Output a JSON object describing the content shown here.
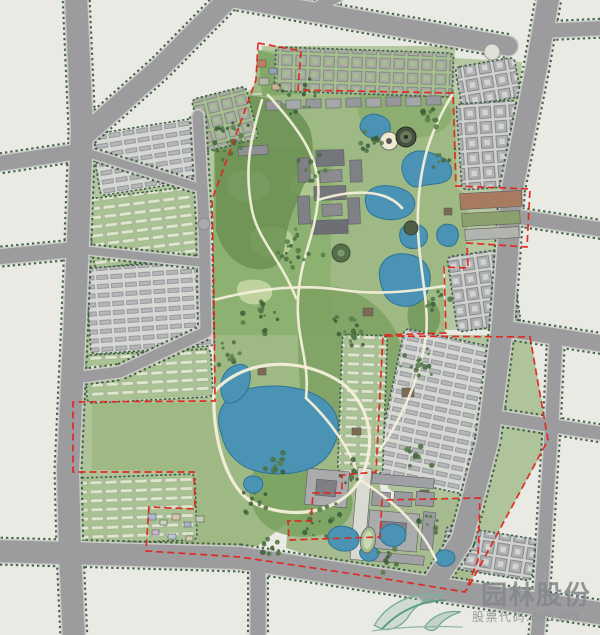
{
  "watermark": {
    "reg": "®",
    "company": "园林股份",
    "stock": "股票代码:605303",
    "logo_icon": "leaf-swirl-icon",
    "text_color": "#85888b",
    "logo_color": "#6fa18e"
  },
  "palette": {
    "background": "#e8eae3",
    "road": "#9c9c9e",
    "road_edge": "#cbccc6",
    "tree_line": "#3a5a42",
    "park_green": "#9fb985",
    "forest_green": "#6b9152",
    "lake_blue": "#4a93b4",
    "boundary_red": "#e3251c",
    "path_cream": "#f4efda",
    "building_gray": "#9a9b9f"
  },
  "map": {
    "w": 600,
    "h": 635,
    "bg": "#e8eae3",
    "belts": [
      {
        "d": "M88,136 L200,120 L253,88 L253,148 L212,200 L210,335 L120,372 L80,375 L74,340 L78,240 Z",
        "fill": "#b4c79f"
      },
      {
        "d": "M74,378 L120,374 L208,334 L213,402 L92,403 L92,470 L196,472 L196,545 L72,550 Z",
        "fill": "#aec39a"
      },
      {
        "d": "M262,46 L455,46 L455,96 L262,98 Z",
        "fill": "#b6c8a2"
      },
      {
        "d": "M455,58 L522,62 L512,190 L502,330 L445,330 L445,267 L466,268 L467,243 L456,244 L456,186 Z",
        "fill": "#b6c8a2"
      },
      {
        "d": "M385,334 L530,336 L549,440 L466,590 L428,586 L443,530 L388,488 Z",
        "fill": "#b0c49c"
      },
      {
        "d": "M288,523 L311,521 L313,493 L341,493 L341,475 L378,472 L382,500 L480,498 L477,562 L464,592 L380,578 L286,548 Z",
        "fill": "#a6bc90"
      }
    ],
    "parkShapes": [
      {
        "d": "M213,95 L455,92 L457,188 L468,196 L466,268 L443,267 L445,334 L383,336 L375,472 L341,475 L341,493 L313,493 L311,521 L288,522 L258,546 L150,552 L152,508 L196,508 L196,472 L92,470 L92,403 L214,402 L213,200 L255,82 L258,50 L298,52 L295,92 Z",
        "fill": "#9fb985"
      }
    ],
    "patches": [
      {
        "d": "M214,150 L332,148 L330,335 L212,335 Z",
        "fill": "#8cb170",
        "op": 1
      },
      {
        "d": "M230,175 C250,165 272,172 270,188 C268,202 240,206 232,196 C226,188 224,182 230,175 Z",
        "fill": "#c3d7a3",
        "op": 0.9
      },
      {
        "d": "M255,230 C275,222 296,228 293,244 C290,258 262,262 254,250 C248,241 248,236 255,230 Z",
        "fill": "#bcd19c",
        "op": 0.9
      },
      {
        "d": "M240,282 C258,276 274,282 272,294 C270,306 246,308 240,298 C236,291 236,287 240,282 Z",
        "fill": "#c3d7a3",
        "op": 0.9
      },
      {
        "d": "M296,175 C310,170 320,176 318,188 C316,200 298,202 292,192 C288,185 290,180 296,175 Z",
        "fill": "#b7cd97",
        "op": 0.8
      },
      {
        "d": "M214,96 C260,92 300,100 310,130 C320,160 300,190 290,220 C282,246 288,262 270,268 C248,274 224,260 216,230 Z",
        "fill": "#6b9152",
        "op": 0.85
      },
      {
        "d": "M300,290 C330,280 360,290 380,310 C400,330 410,360 400,390 C390,420 370,430 350,440 C330,450 310,440 305,420 C298,390 296,330 300,290 Z",
        "fill": "#7aa05f",
        "op": 0.8
      },
      {
        "d": "M255,470 C285,460 320,465 340,480 C360,495 355,520 335,530 C310,542 275,538 260,520 C248,505 246,482 255,470 Z",
        "fill": "#77a05c",
        "op": 0.8
      },
      {
        "d": "M360,95 C400,92 440,95 452,110 C455,130 430,140 400,138 C370,136 350,120 360,95 Z",
        "fill": "#84a968",
        "op": 0.7
      },
      {
        "d": "M258,50 C285,55 305,72 303,94 L262,96 Z",
        "fill": "#7fa765",
        "op": 0.9
      },
      {
        "d": "M300,55 C330,52 360,55 358,70 C356,84 320,88 305,80 C295,73 294,62 300,55 Z",
        "fill": "#bed3a0",
        "op": 0.8
      },
      {
        "d": "M380,420 C400,412 420,418 418,434 C416,448 392,452 384,442 C378,434 376,428 380,420 Z",
        "fill": "#b5cc96",
        "op": 0.9
      },
      {
        "d": "M412,300 C430,295 442,305 440,320 C438,338 420,342 412,332 C406,324 406,308 412,300 Z",
        "fill": "#6f9556",
        "op": 0.8
      },
      {
        "d": "M225,415 C245,405 268,408 270,424 C272,440 248,448 234,440 C224,434 220,424 225,415 Z",
        "fill": "#b8cf99",
        "op": 0.6
      }
    ],
    "blockStyles": {
      "slab": {
        "bg": "#d6d8d3",
        "pat": "patSlab"
      },
      "greenrow": {
        "bg": "#a9c294",
        "pat": "patGreenrow"
      },
      "court": {
        "bg": "#cfd1cd",
        "pat": "patCourt"
      },
      "greencourt": {
        "bg": "#a5bf90",
        "pat": "patGreencourt"
      }
    },
    "blocks": [
      [
        197,
        92,
        56,
        54,
        -14,
        "greencourt"
      ],
      [
        95,
        126,
        105,
        62,
        -9,
        "slab"
      ],
      [
        90,
        192,
        115,
        70,
        -7,
        "greenrow"
      ],
      [
        88,
        264,
        124,
        86,
        -4,
        "slab"
      ],
      [
        86,
        352,
        126,
        48,
        -3,
        "greenrow"
      ],
      [
        78,
        476,
        118,
        66,
        -2,
        "greenrow"
      ],
      [
        275,
        50,
        178,
        44,
        2,
        "greencourt"
      ],
      [
        458,
        62,
        60,
        40,
        -10,
        "court"
      ],
      [
        459,
        102,
        60,
        86,
        -4,
        "court"
      ],
      [
        452,
        252,
        64,
        76,
        -8,
        "court"
      ],
      [
        388,
        337,
        100,
        150,
        12,
        "slab"
      ],
      [
        340,
        335,
        45,
        138,
        2,
        "greenrow"
      ],
      [
        443,
        532,
        92,
        42,
        9,
        "court"
      ]
    ],
    "roads": [
      {
        "d": "M76,-5 L82,130 L78,240 L74,340 L68,470 L70,552 L74,640",
        "w": 22
      },
      {
        "d": "M230,-3 L160,68 L86,134",
        "w": 20
      },
      {
        "d": "M-4,164 L82,151",
        "w": 15
      },
      {
        "d": "M-4,257 L80,249",
        "w": 15
      },
      {
        "d": "M228,-3 L370,22 L508,46",
        "w": 19
      },
      {
        "d": "M305,14 L338,-4",
        "w": 11
      },
      {
        "d": "M549,-5 L536,70 L512,190 L502,330 L488,440 L462,540 L428,592",
        "w": 21
      },
      {
        "d": "M540,31 L605,28",
        "w": 14
      },
      {
        "d": "M505,215 L605,230",
        "w": 14
      },
      {
        "d": "M500,328 L605,344",
        "w": 16
      },
      {
        "d": "M503,418 L605,434",
        "w": 13
      },
      {
        "d": "M556,338 L552,420 L542,580 L537,640",
        "w": 13
      },
      {
        "d": "M-5,551 L240,558 L420,586 L605,614",
        "w": 22
      },
      {
        "d": "M258,561 L258,640",
        "w": 15
      },
      {
        "d": "M198,116 L204,222 L206,332 L120,372 L74,378",
        "w": 11
      },
      {
        "d": "M88,153 L200,188",
        "w": 8
      },
      {
        "d": "M82,250 L205,263",
        "w": 8
      }
    ],
    "roundabouts": [
      [
        204,
        224,
        6
      ]
    ],
    "buildings": [
      [
        316,
        150,
        28,
        16,
        -2,
        "#75767b"
      ],
      [
        320,
        170,
        22,
        12,
        -2,
        "#8b8c90"
      ],
      [
        314,
        186,
        32,
        14,
        -2,
        "#75767b"
      ],
      [
        322,
        204,
        20,
        12,
        -2,
        "#8b8c90"
      ],
      [
        312,
        220,
        36,
        14,
        -2,
        "#6e6f74"
      ],
      [
        298,
        158,
        12,
        24,
        -2,
        "#808186"
      ],
      [
        350,
        160,
        12,
        22,
        -2,
        "#808186"
      ],
      [
        298,
        196,
        12,
        28,
        -2,
        "#808186"
      ],
      [
        348,
        198,
        12,
        26,
        -2,
        "#808186"
      ],
      [
        238,
        146,
        30,
        9,
        -4,
        "#8f9094"
      ],
      [
        266,
        101,
        15,
        9,
        -1,
        "#97989c"
      ],
      [
        286,
        100,
        15,
        9,
        -1,
        "#a6a7aa"
      ],
      [
        306,
        99,
        15,
        9,
        -1,
        "#97989c"
      ],
      [
        326,
        99,
        15,
        9,
        -1,
        "#a6a7aa"
      ],
      [
        346,
        98,
        15,
        9,
        -1,
        "#97989c"
      ],
      [
        366,
        98,
        15,
        9,
        -1,
        "#a6a7aa"
      ],
      [
        386,
        97,
        15,
        9,
        -1,
        "#97989c"
      ],
      [
        406,
        97,
        15,
        9,
        -1,
        "#a6a7aa"
      ],
      [
        426,
        96,
        15,
        9,
        -1,
        "#97989c"
      ],
      [
        430,
        163,
        10,
        8,
        0,
        "#7c6a52"
      ],
      [
        444,
        208,
        8,
        7,
        0,
        "#7c6a52"
      ],
      [
        363,
        308,
        10,
        8,
        0,
        "#7c6a52"
      ],
      [
        258,
        368,
        8,
        7,
        0,
        "#7c6a52"
      ],
      [
        402,
        388,
        12,
        9,
        0,
        "#7c6a52"
      ],
      [
        352,
        428,
        9,
        7,
        0,
        "#7c6a52"
      ],
      [
        298,
        452,
        10,
        8,
        0,
        "#7c6a52"
      ],
      [
        420,
        490,
        9,
        7,
        0,
        "#7c6a52"
      ],
      [
        306,
        470,
        42,
        36,
        5,
        "#a9abad"
      ],
      [
        316,
        480,
        20,
        16,
        5,
        "#7e7f83"
      ],
      [
        354,
        468,
        14,
        92,
        5,
        "#d9dad2"
      ],
      [
        372,
        476,
        62,
        10,
        5,
        "#a0a1a5"
      ],
      [
        372,
        492,
        18,
        14,
        5,
        "#9a9b9f"
      ],
      [
        394,
        492,
        18,
        14,
        5,
        "#9a9b9f"
      ],
      [
        416,
        492,
        18,
        14,
        5,
        "#9a9b9f"
      ],
      [
        368,
        512,
        50,
        38,
        5,
        "#a9abad"
      ],
      [
        380,
        522,
        26,
        18,
        5,
        "#7e7f83"
      ],
      [
        422,
        512,
        12,
        38,
        5,
        "#9a9b9f"
      ],
      [
        372,
        554,
        52,
        9,
        5,
        "#a0a1a5"
      ],
      [
        460,
        192,
        62,
        16,
        -3,
        "#a87a5f"
      ],
      [
        462,
        212,
        58,
        13,
        -3,
        "#8ba06c"
      ],
      [
        465,
        228,
        54,
        11,
        -3,
        "#b2b4af"
      ],
      [
        257,
        60,
        9,
        7,
        0,
        "#c07c5c"
      ],
      [
        269,
        68,
        8,
        6,
        0,
        "#93a3bb"
      ],
      [
        259,
        78,
        10,
        7,
        0,
        "#b1b9a2"
      ],
      [
        272,
        84,
        8,
        6,
        0,
        "#c9b48e"
      ],
      [
        148,
        514,
        8,
        6,
        0,
        "#aab8cc"
      ],
      [
        160,
        520,
        7,
        5,
        0,
        "#cdd5ba"
      ],
      [
        172,
        514,
        8,
        6,
        0,
        "#d8c7a6"
      ],
      [
        184,
        522,
        7,
        5,
        0,
        "#a3b8c6"
      ],
      [
        196,
        516,
        8,
        6,
        0,
        "#c2cdb4"
      ],
      [
        152,
        530,
        7,
        5,
        0,
        "#c8b8d0"
      ],
      [
        168,
        534,
        8,
        5,
        0,
        "#b8c8d8"
      ],
      [
        186,
        536,
        7,
        5,
        0,
        "#d5cead"
      ]
    ],
    "lakeStyle": {
      "fill": "#4a93b4",
      "stroke": "#2f7396"
    },
    "lakes": [
      "M360,128 C360,117 370,112 379,115 C390,118 393,127 388,135 C382,142 364,140 360,128 Z",
      "M402,170 C400,156 414,148 428,152 C444,156 454,164 451,175 C448,186 430,183 422,186 C410,190 404,180 402,170 Z",
      "M366,205 C362,192 374,184 390,186 C406,188 418,196 414,208 C410,219 392,222 380,218 C370,215 368,212 366,205 Z",
      "M400,238 C398,228 406,222 416,224 C426,226 430,234 426,242 C422,249 412,250 406,247 C401,244 401,242 400,238 Z",
      "M380,280 C376,262 390,252 406,254 C422,256 432,266 430,282 C428,298 418,308 402,306 C388,304 383,295 380,280 Z",
      "M437,238 C435,228 443,222 452,225 C460,228 460,238 455,244 C450,249 439,246 437,238 Z",
      "M220,430 C214,408 228,392 252,388 C276,384 300,386 318,396 C336,406 342,422 336,440 C330,458 318,468 298,472 C278,476 252,474 238,462 C226,452 224,444 220,430 Z",
      "M222,396 C218,381 224,369 236,365 C246,362 252,369 250,381 C248,393 240,401 232,403 C226,404 224,401 222,396 Z",
      "M244,486 C242,478 250,474 258,477 C265,480 264,488 258,492 C252,495 246,492 244,486 Z",
      "M328,540 C326,530 336,524 348,527 C358,530 362,538 357,546 C352,553 340,552 334,548 C330,545 329,544 328,540 Z",
      "M360,555 C358,548 366,544 374,547 C380,550 380,557 374,560 C368,563 362,560 360,555 Z",
      "M380,538 C378,528 388,522 398,525 C407,528 408,537 402,543 C396,549 384,547 380,538 Z",
      "M436,560 C434,552 442,548 450,551 C457,554 456,562 450,565 C444,568 438,566 436,560 Z"
    ],
    "pathStyle": {
      "stroke": "#f4efda",
      "w": 2.6
    },
    "paths": [
      "M268,95 C300,130 322,160 318,200 C314,240 300,258 298,300 C296,340 310,360 306,398",
      "M452,95 C432,128 420,160 418,210 C416,258 430,300 426,336",
      "M214,300 C260,288 302,284 342,290 C382,296 420,290 444,286",
      "M214,392 C240,362 290,356 330,376 C368,394 380,440 360,480 C340,514 292,520 256,504 C228,492 212,440 214,392",
      "M360,480 C392,500 420,524 436,560",
      "M318,200 C350,190 385,188 402,208",
      "M306,398 C330,420 350,450 356,470",
      "M262,100 C250,140 244,170 252,210 C258,240 280,258 296,298",
      "M426,336 C420,380 400,420 380,450"
    ],
    "circles": [
      [
        389,
        141,
        9,
        "#f0e9d1",
        "#6b6c6e"
      ],
      [
        389,
        141,
        3,
        "#55565a",
        "none"
      ],
      [
        406,
        137,
        10,
        "#46513f",
        "#23281f"
      ],
      [
        406,
        137,
        6,
        "#68795c",
        "none"
      ],
      [
        406,
        137,
        2,
        "#2a2f24",
        "none"
      ],
      [
        341,
        253,
        9,
        "#55704b",
        "#3c5236"
      ],
      [
        341,
        253,
        3.5,
        "#7e9971",
        "none"
      ],
      [
        411,
        228,
        7,
        "#4e5f46",
        "#333d2e"
      ],
      [
        492,
        52,
        8,
        "#dfe1d8",
        "#9a9b95"
      ]
    ],
    "stadium": {
      "cx": 368,
      "cy": 540,
      "rx": 7.5,
      "ry": 13,
      "rot": 8,
      "fill": "#a8bd92",
      "stroke": "#6f7072",
      "irx": 4.5,
      "iry": 9,
      "ifill": "#c9d8b4"
    },
    "treeColors": [
      "#4a6e41",
      "#3a5c36",
      "#567b49"
    ],
    "treeClusters": [
      [
        230,
        140,
        24,
        42
      ],
      [
        298,
        250,
        18,
        46
      ],
      [
        260,
        318,
        14,
        40
      ],
      [
        350,
        330,
        18,
        40
      ],
      [
        418,
        368,
        14,
        34
      ],
      [
        282,
        462,
        12,
        34
      ],
      [
        320,
        518,
        14,
        34
      ],
      [
        252,
        506,
        10,
        28
      ],
      [
        420,
        450,
        10,
        28
      ],
      [
        372,
        142,
        10,
        28
      ],
      [
        432,
        120,
        9,
        24
      ],
      [
        352,
        470,
        10,
        26
      ],
      [
        388,
        558,
        10,
        28
      ],
      [
        300,
        96,
        14,
        46
      ],
      [
        438,
        298,
        9,
        22
      ],
      [
        232,
        356,
        10,
        30
      ],
      [
        310,
        170,
        10,
        30
      ],
      [
        430,
        520,
        8,
        24
      ],
      [
        270,
        540,
        9,
        26
      ],
      [
        445,
        160,
        8,
        22
      ]
    ],
    "red": {
      "color": "#e3251c",
      "paths": [
        "M258,43 L301,51 L298,90 L453,93 L456,186 L530,189 L527,247 L467,243 L468,268 L444,267 L446,333 L383,335 L376,472 L342,475 L342,493 L313,493 L311,521 L288,521 L289,540 L380,537 L382,500 L480,498 L478,560 L465,592 L380,578 L240,557 L146,551 L149,507 L195,509 L194,472 L73,472 L73,402 L215,401 L214,303 L212,200 L256,80 Z",
        "M386,336 L530,337 L548,440 L467,590"
      ]
    }
  }
}
